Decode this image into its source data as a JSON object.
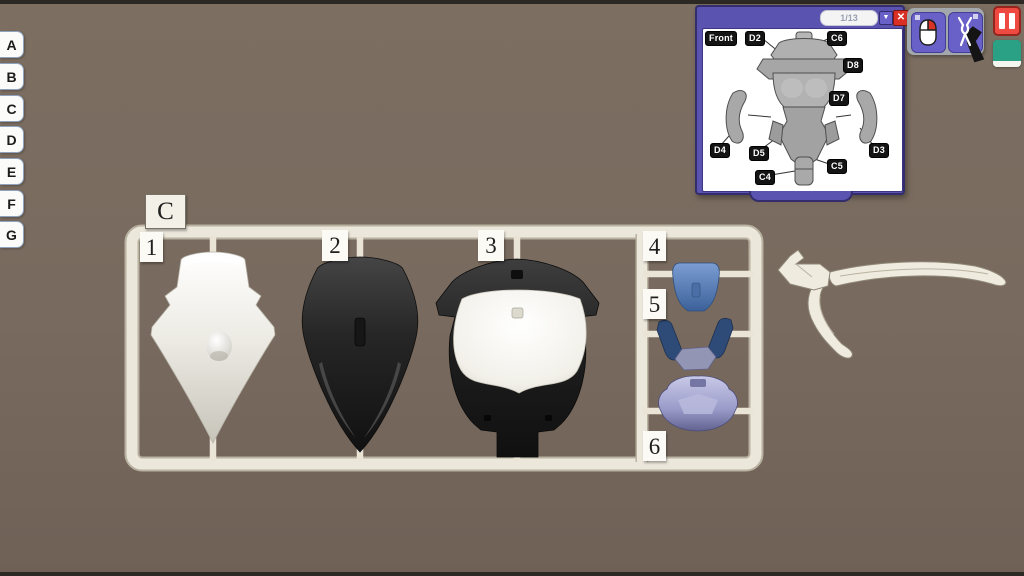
{
  "scene": {
    "background_color": "#77695d",
    "letterbox_color": "#2c2823"
  },
  "runner_tabs": {
    "items": [
      {
        "label": "A"
      },
      {
        "label": "B"
      },
      {
        "label": "C"
      },
      {
        "label": "D"
      },
      {
        "label": "E"
      },
      {
        "label": "F"
      },
      {
        "label": "G"
      }
    ]
  },
  "runner": {
    "tag_label": "C",
    "frame_color": "#ece7db",
    "slots": [
      {
        "number": "1",
        "part_color": "#e9e7e0"
      },
      {
        "number": "2",
        "part_color": "#2a2a2a"
      },
      {
        "number": "3",
        "part_color": "#1f1f1f"
      },
      {
        "number": "4",
        "part_color": "#5d85c1"
      },
      {
        "number": "5",
        "part_color": "#2e4a76"
      },
      {
        "number": "6",
        "part_color": "#9a9bc9"
      }
    ]
  },
  "manual": {
    "page_indicator": "1/13",
    "front_label": "Front",
    "labels": [
      {
        "text": "D2"
      },
      {
        "text": "C6"
      },
      {
        "text": "D8"
      },
      {
        "text": "D7"
      },
      {
        "text": "D4"
      },
      {
        "text": "D5"
      },
      {
        "text": "D3"
      },
      {
        "text": "C5"
      },
      {
        "text": "C4"
      }
    ],
    "titlebar_color": "#5b53b0",
    "close_color": "#d93025"
  },
  "toolbar": {
    "mouse_icon": "mouse-right-click",
    "tool_icon": "nippers",
    "pause_color": "#ee4a41",
    "swatch_color": "#2aa084"
  },
  "workbench_tool": {
    "name": "nippers",
    "color": "#f0ebdf"
  }
}
